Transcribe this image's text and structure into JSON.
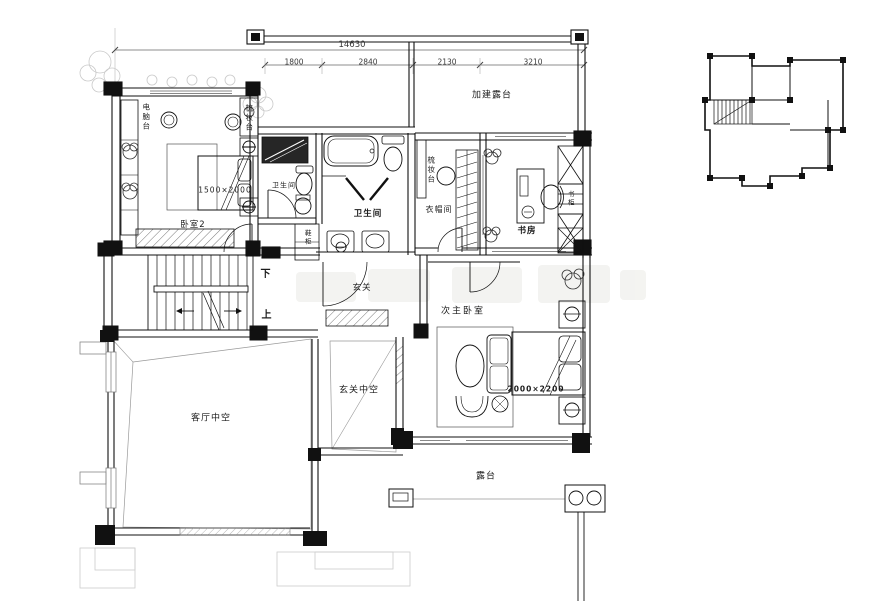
{
  "dims": {
    "total": "14630",
    "seg1": "1800",
    "seg2": "2840",
    "seg3": "2130",
    "seg4": "3210"
  },
  "labels": {
    "added_terrace": "加建露台",
    "bedroom2": "卧室2",
    "bedroom2_bed": "1500×2000",
    "computer_desk": "电脑台",
    "dresser_bedroom": "梳妆台",
    "bathroom1": "卫生间",
    "shoe_cabinet": "鞋柜",
    "bathroom2": "卫生间",
    "dresser_hall": "梳妆台",
    "cloakroom": "衣帽间",
    "study": "书房",
    "bookcase": "书柜",
    "foyer": "玄关",
    "stairs_down": "下",
    "stairs_up": "上",
    "living_void": "客厅中空",
    "foyer_void": "玄关中空",
    "second_master_bedroom": "次主卧室",
    "master_bed": "2000×2200",
    "terrace": "露台"
  }
}
